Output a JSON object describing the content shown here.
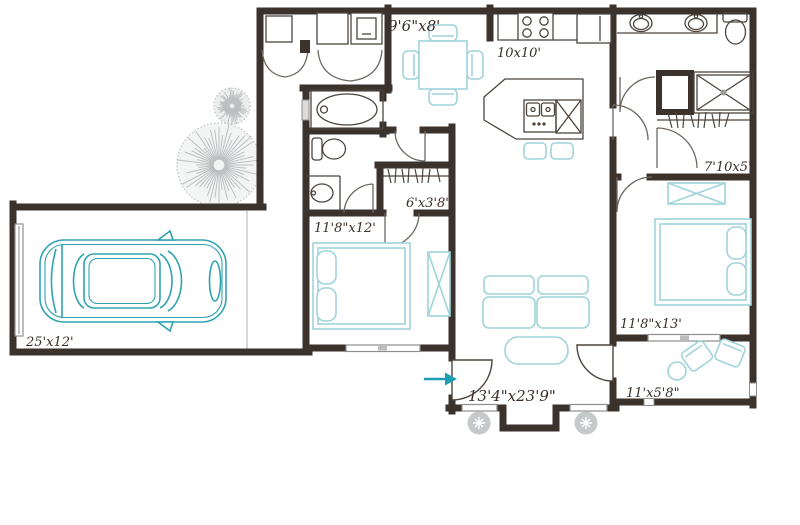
{
  "floorplan": {
    "title": "apartment-floor-plan",
    "colors": {
      "wall": "#3b322b",
      "fixture": "#4c443d",
      "window_gray": "#8e8e8e",
      "furniture_teal": "#9fd4da",
      "car_teal": "#2fa3b1",
      "landscape_gray": "#c6c9ca",
      "label": "#3a2f28",
      "arrow_teal": "#1d9eb5"
    },
    "rooms": {
      "dining": {
        "label": "9'6\"x8'"
      },
      "kitchen": {
        "label": "10x10'"
      },
      "walkin_closet": {
        "label": "7'10x5'"
      },
      "hall_closet": {
        "label": "6'x3'8\""
      },
      "bedroom1": {
        "label": "11'8\"x12'"
      },
      "bedroom2": {
        "label": "11'8\"x13'"
      },
      "garage": {
        "label": "25'x12'"
      },
      "living": {
        "label": "13'4\"x23'9\""
      },
      "patio": {
        "label": "11'x5'8\""
      }
    },
    "icons": [
      "car-icon",
      "dining-table-icon",
      "bar-stool-icon",
      "sofa-icon",
      "ottoman-icon",
      "bed-icon",
      "pillow-icon",
      "dresser-icon",
      "patio-chair-icon",
      "patio-table-icon",
      "washer-icon",
      "dryer-icon",
      "water-heater-icon",
      "bathtub-icon",
      "toilet-icon",
      "sink-icon",
      "double-vanity-icon",
      "shower-icon",
      "stove-icon",
      "fridge-icon",
      "kitchen-island-icon",
      "dishwasher-icon",
      "hanging-rod-icon",
      "door-swing-icon",
      "window-icon",
      "tree-icon",
      "bush-icon",
      "entry-arrow-icon"
    ]
  }
}
